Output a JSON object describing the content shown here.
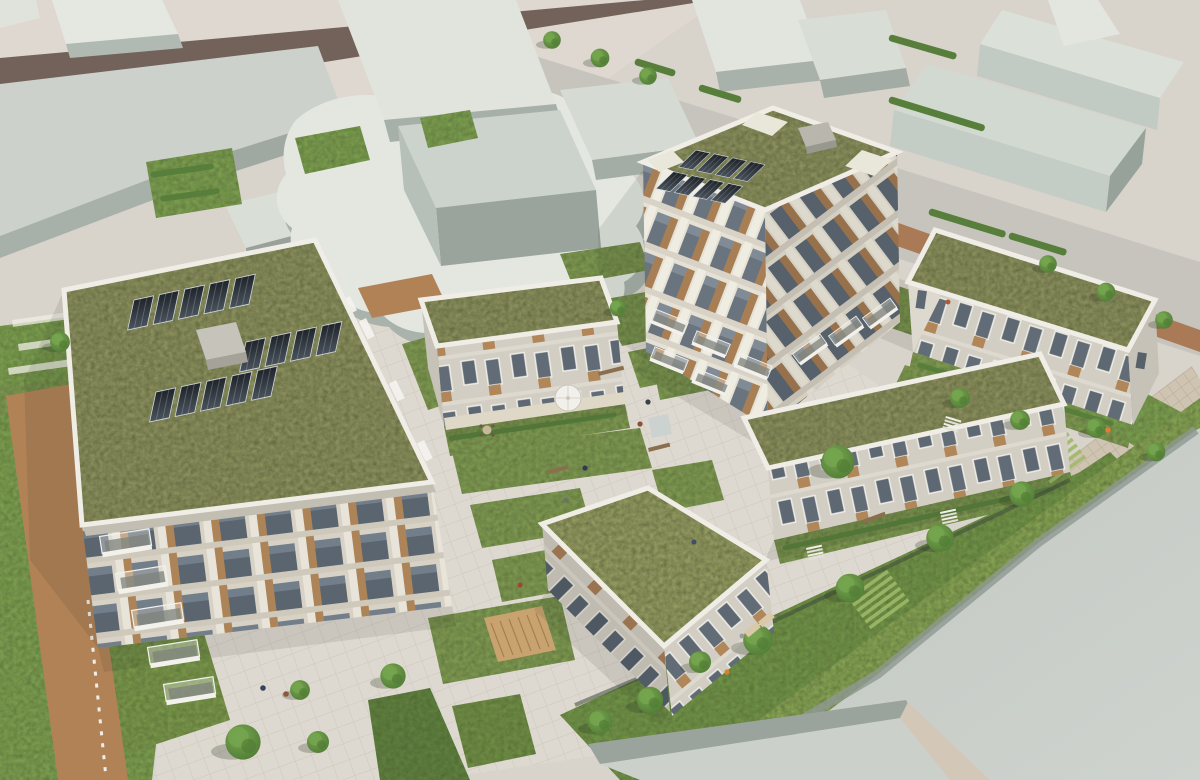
{
  "meta": {
    "kind": "architectural-aerial-rendering",
    "description": "Aerial 3D visualization of a residential courtyard development with biodiverse green roofs, rooftop solar panels and landscaped gardens, surrounded by plain massing-model context buildings, a tree-lined street with a red bike lane, lawns and a wildflower meadow.",
    "width": 1200,
    "height": 780
  },
  "palette": {
    "pavement": "#d8d3cb",
    "pavement_light": "#ded8d0",
    "plaza": "#ded9d0",
    "road": "#72625a",
    "asphalt": "#c7c4be",
    "bike_path": "#aa7a56",
    "walkway": "#cfc3b2",
    "path_brick": "#b28257",
    "lawn": "#7a9c4e",
    "meadow": "#84a052",
    "bed": "#7d9750",
    "hedge": "#577f3b",
    "context_top": "#dce0d8",
    "context_side": "#a7b1a9",
    "context_face_light": "#c3ccc5",
    "big_roof": "#c6cbc6",
    "big_roof_edge": "#8e9992",
    "green_roof": "#8a8d5c",
    "green_roof_light": "#9ba363",
    "parapet": "#efede6",
    "solar_dark": "#22272d",
    "solar_light": "#454e58",
    "facade_stone": "#d7d2c5",
    "wood": "#ad8458",
    "glass": "#5b6570",
    "brick_row": "#d2cec4",
    "white": "#f4f3ef",
    "tree_mid": "#5d8c3f",
    "deck": "#c9a36f",
    "purple_flowers": "#9c7fae"
  },
  "scene": {
    "development": {
      "west_tower": {
        "label": "apartment tower with green roof",
        "solar_panels": 14,
        "roof_access_boxes": 1,
        "corner_balconies": 5
      },
      "north_tower": {
        "label": "apartment tower with green roof and corner roof terraces",
        "solar_panels": 8,
        "roof_terraces": 3
      },
      "row_houses": [
        {
          "label": "townhouse row A (courtyard north-west)"
        },
        {
          "label": "townhouse row B (upper right, along street)"
        },
        {
          "label": "townhouse row C (long row, centre right)"
        },
        {
          "label": "townhouse row D (lower centre)"
        }
      ],
      "courtyard_features": [
        "stone paving",
        "wildflower planting beds",
        "timber deck",
        "benches",
        "white parasol",
        "small water feature",
        "footpaths"
      ]
    },
    "context": {
      "massing_buildings": 15,
      "street": {
        "tree_lined": true,
        "bike_lane": true,
        "bike_lane_dashes": 8
      }
    },
    "landscape": {
      "trees": 24,
      "lawn": true,
      "wildflower_meadow": true,
      "brick_footpath": true
    },
    "figures": {
      "pedestrians": 12,
      "benches": 4,
      "stair_flights": 3
    }
  }
}
